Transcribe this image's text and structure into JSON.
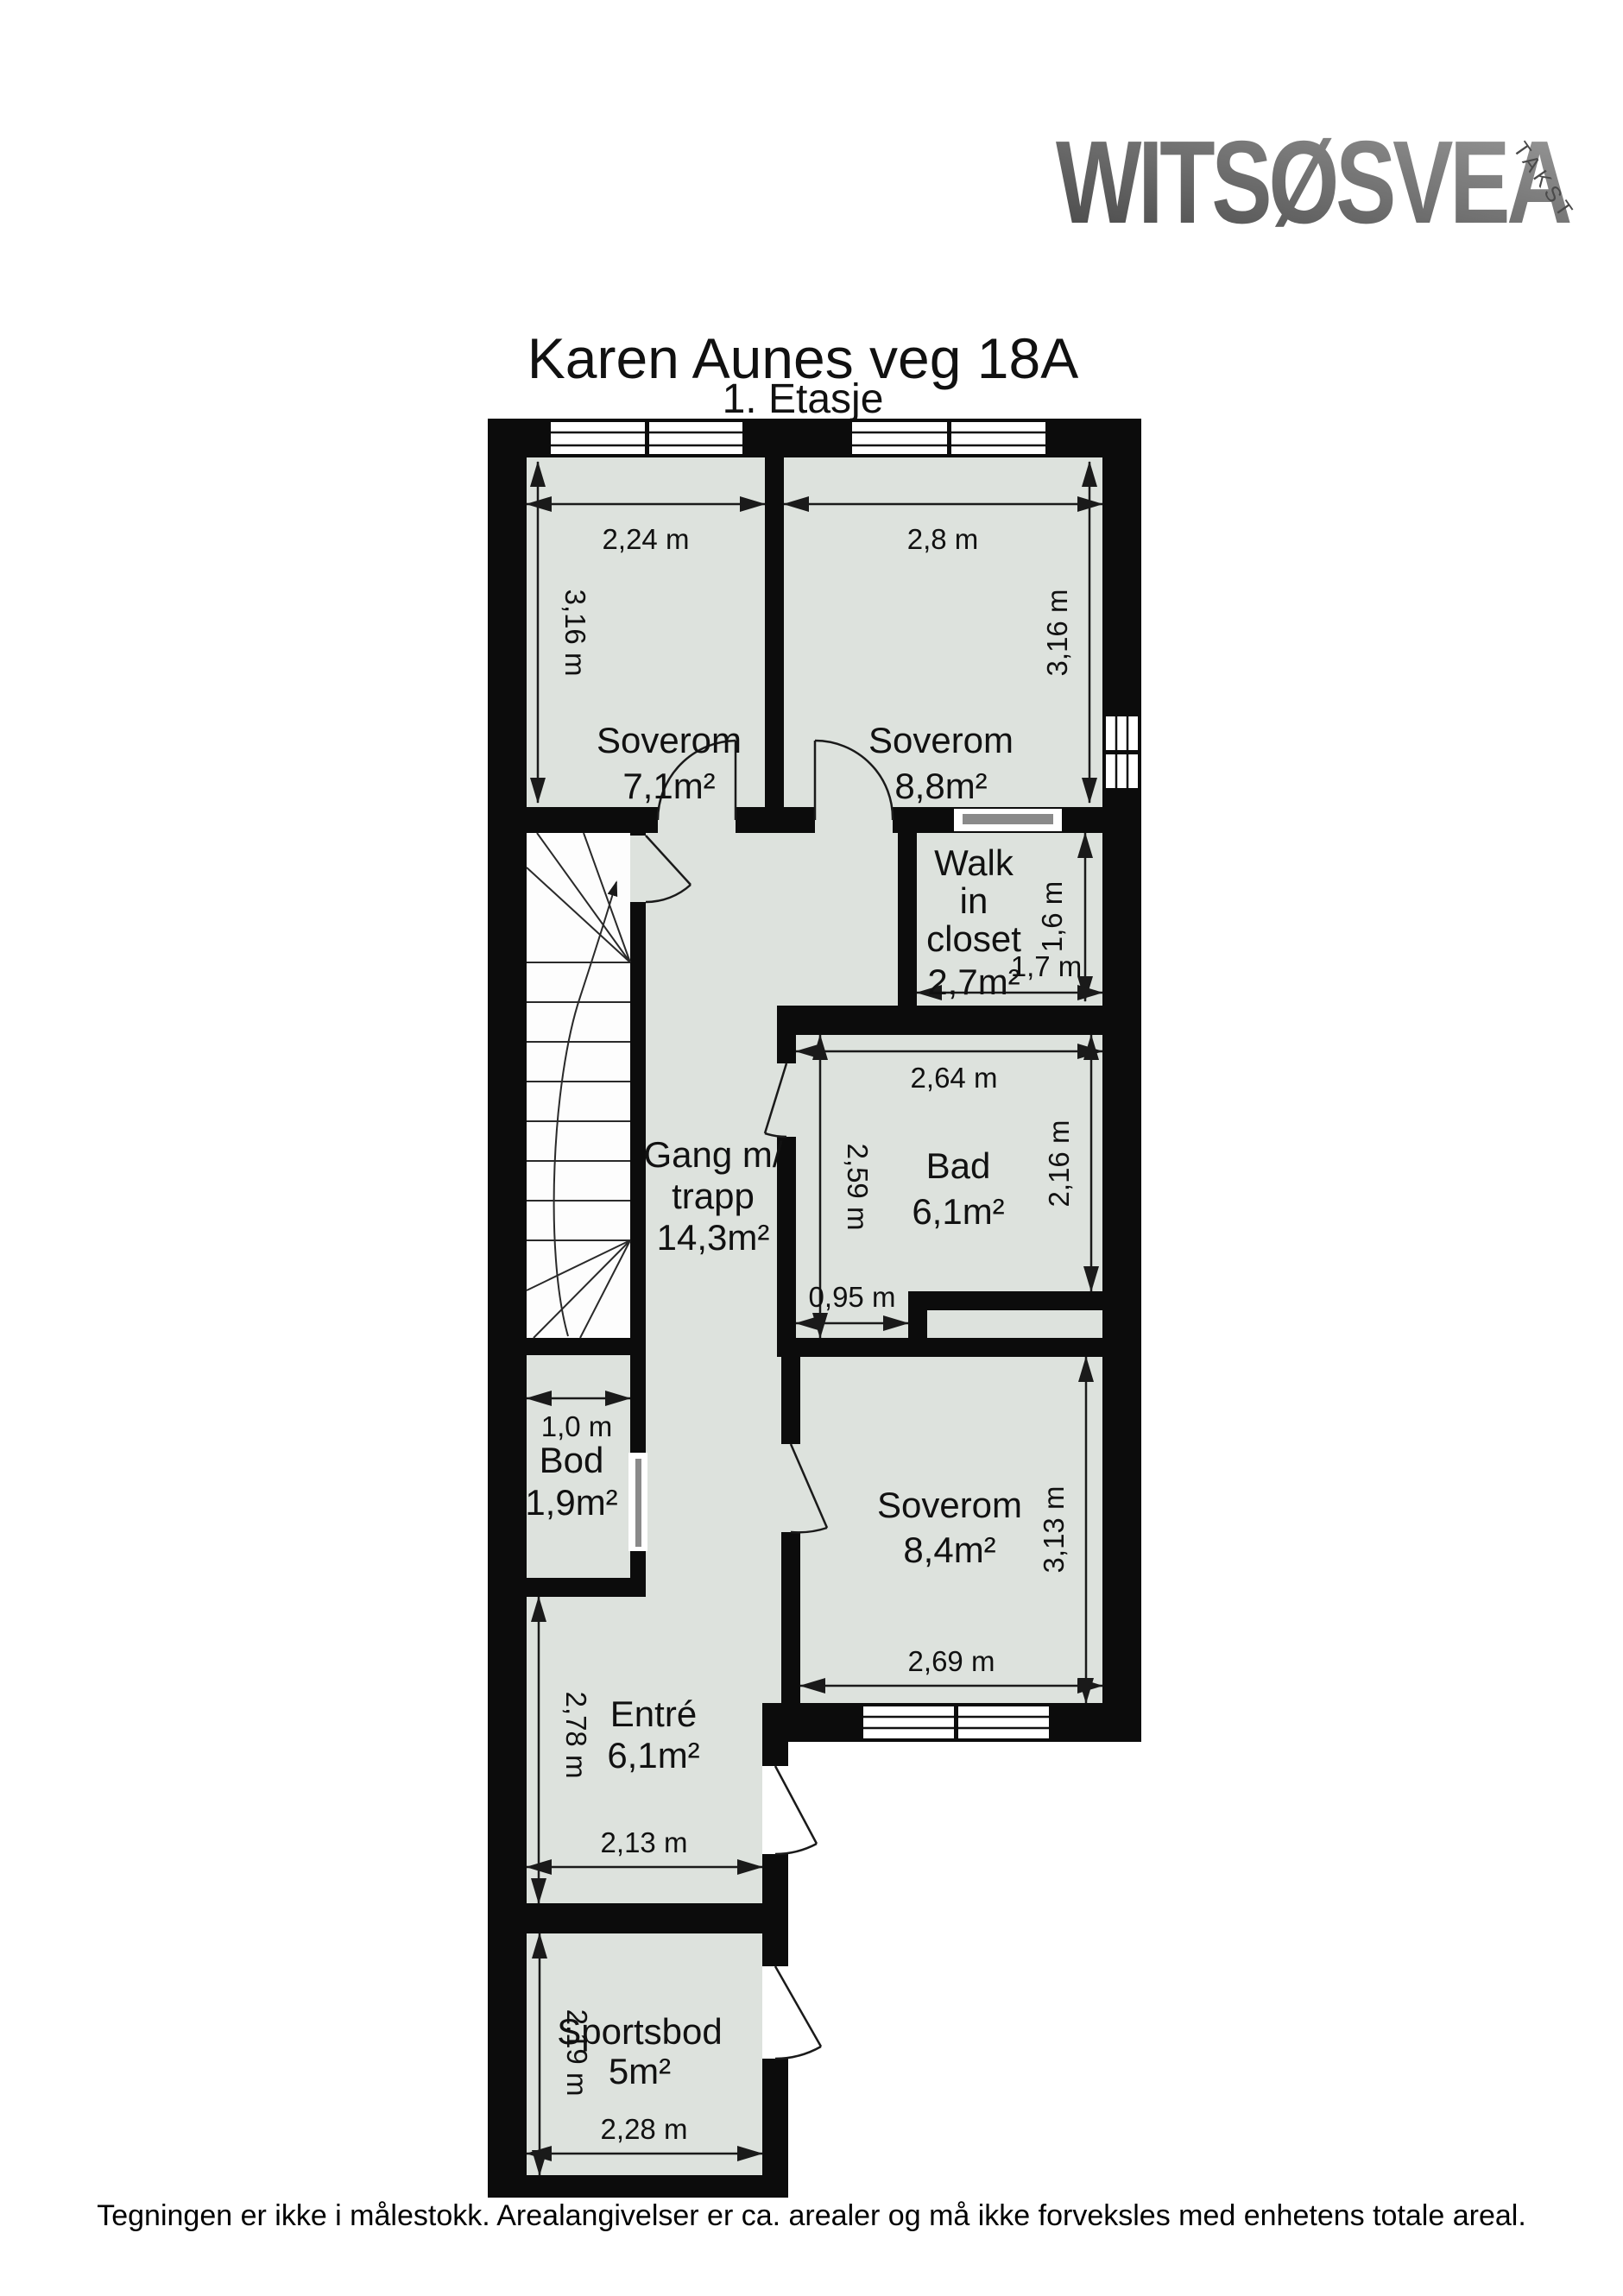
{
  "header": {
    "title": "Karen Aunes veg 18A",
    "subtitle": "1. Etasje"
  },
  "logo": {
    "brand": "WITSØSVEA",
    "tagline": "TAKST"
  },
  "rooms": {
    "soverom1": {
      "name": "Soverom",
      "area": "7,1m²"
    },
    "soverom2": {
      "name": "Soverom",
      "area": "8,8m²"
    },
    "wic": {
      "line1": "Walk",
      "line2": "in",
      "line3": "closet",
      "area": "2,7m²"
    },
    "bad": {
      "name": "Bad",
      "area": "6,1m²"
    },
    "gang": {
      "line1": "Gang m/",
      "line2": "trapp",
      "area": "14,3m²"
    },
    "bod": {
      "name": "Bod",
      "area": "1,9m²"
    },
    "soverom3": {
      "name": "Soverom",
      "area": "8,4m²"
    },
    "entre": {
      "name": "Entré",
      "area": "6,1m²"
    },
    "sportsbod": {
      "name": "Sportsbod",
      "area": "5m²"
    }
  },
  "dims": {
    "soverom1_width": "2,24 m",
    "soverom2_width": "2,8 m",
    "soverom1_height": "3,16 m",
    "soverom2_height": "3,16 m",
    "wic_height": "1,6 m",
    "wic_width": "1,7 m",
    "bad_width": "2,64 m",
    "bad_height_left": "2,59 m",
    "bad_height_right": "2,16 m",
    "bad_bottom": "0,95 m",
    "bod_width": "1,0 m",
    "soverom3_height": "3,13 m",
    "soverom3_width": "2,69 m",
    "entre_height": "2,78 m",
    "entre_width": "2,13 m",
    "sportsbod_height": "2,19 m",
    "sportsbod_width": "2,28 m"
  },
  "footer": {
    "disclaimer": "Tegningen er ikke i målestokk. Arealangivelser er ca. arealer og må ikke forveksles med enhetens totale areal."
  },
  "colors": {
    "floor": "#dde2dd",
    "wall": "#0c0c0c",
    "stairs": "#fdfdfd",
    "logo_dark": "#454545",
    "logo_light": "#989898"
  }
}
